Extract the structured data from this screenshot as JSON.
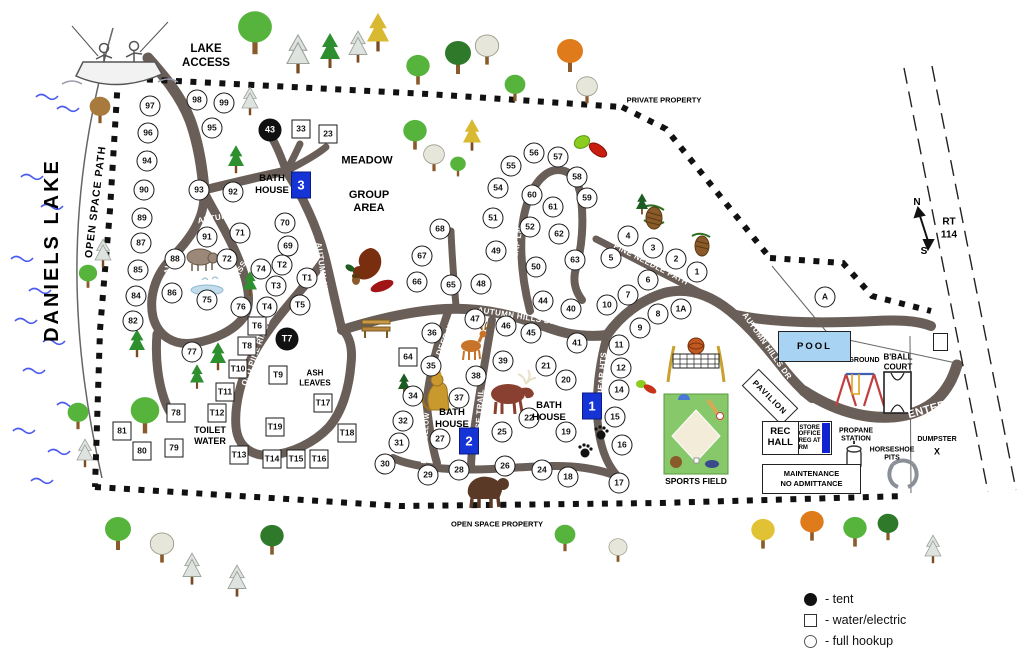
{
  "labels": {
    "daniels_lake": "DANIELS LAKE",
    "open_space_path": "OPEN SPACE PATH",
    "lake_access_1": "LAKE",
    "lake_access_2": "ACCESS",
    "private_property": "PRIVATE PROPERTY",
    "open_space_property": "OPEN SPACE PROPERTY",
    "meadow": "MEADOW",
    "group_1": "GROUP",
    "group_2": "AREA",
    "ash_1": "ASH",
    "ash_2": "LEAVES",
    "toilet_1": "TOILET",
    "toilet_2": "WATER",
    "pool": "POOL",
    "pavilion": "PAVILION",
    "playground": "PLAYGROUND",
    "bball_1": "B'BALL",
    "bball_2": "COURT",
    "sports_field": "SPORTS FIELD",
    "rec_1": "REC",
    "rec_2": "HALL",
    "store_1": "STORE",
    "store_2": "OFFICE",
    "store_3": "REG AT RM",
    "propane_1": "PROPANE",
    "propane_2": "STATION",
    "horseshoe_1": "HORSESHOE",
    "horseshoe_2": "PITS",
    "dumpster": "DUMPSTER",
    "dumpster_x": "X",
    "maintenance_1": "MAINTENANCE",
    "maintenance_2": "NO ADMITTANCE",
    "rt_1": "RT",
    "rt_2": "114",
    "compass_n": "N",
    "compass_s": "S"
  },
  "bath_houses": [
    {
      "number": "3",
      "label": "BATH HOUSE",
      "text_x": 272,
      "text_y": 185,
      "box_x": 301,
      "box_y": 185
    },
    {
      "number": "1",
      "label": "BATH HOUSE",
      "text_x": 549,
      "text_y": 412,
      "box_x": 592,
      "box_y": 406
    },
    {
      "number": "2",
      "label": "BATH HOUSE",
      "text_x": 452,
      "text_y": 419,
      "box_x": 469,
      "box_y": 441
    }
  ],
  "road_labels": [
    {
      "text": "LAKESIDE LANDING",
      "x": 172,
      "y": 237,
      "r": -82,
      "fs": 8
    },
    {
      "text": "AUTUMN HILLS DR",
      "x": 237,
      "y": 214,
      "r": -10,
      "fs": 8
    },
    {
      "text": "BASS PASS",
      "x": 233,
      "y": 283,
      "r": -62,
      "fs": 8
    },
    {
      "text": "AUTUMN HILLS DR",
      "x": 324,
      "y": 282,
      "r": 82,
      "fs": 8
    },
    {
      "text": "OLD PINE RIDGE",
      "x": 256,
      "y": 352,
      "r": -70,
      "fs": 8
    },
    {
      "text": "ACORN WAY",
      "x": 439,
      "y": 266,
      "r": -84,
      "fs": 8
    },
    {
      "text": "DEER HILL",
      "x": 447,
      "y": 334,
      "r": -68,
      "fs": 8
    },
    {
      "text": "FOX HOLLOW",
      "x": 426,
      "y": 438,
      "r": -86,
      "fs": 7
    },
    {
      "text": "MOOSE TRAIL",
      "x": 479,
      "y": 419,
      "r": -86,
      "fs": 8
    },
    {
      "text": "BEAR HTS",
      "x": 602,
      "y": 374,
      "r": -85,
      "fs": 8
    },
    {
      "text": "LEAF LN",
      "x": 517,
      "y": 245,
      "r": -80,
      "fs": 8
    },
    {
      "text": "PINE NEEDLE PATH",
      "x": 651,
      "y": 264,
      "r": 27,
      "fs": 8
    },
    {
      "text": "AUTUMN HILLS DR",
      "x": 517,
      "y": 316,
      "r": 9,
      "fs": 8
    },
    {
      "text": "AUTUMN HILLS DR",
      "x": 767,
      "y": 346,
      "r": 55,
      "fs": 8
    },
    {
      "text": "ENTER",
      "x": 927,
      "y": 410,
      "r": -16,
      "fs": 11
    }
  ],
  "sites": {
    "full_hookup": [
      {
        "id": "97",
        "x": 150,
        "y": 106
      },
      {
        "id": "98",
        "x": 197,
        "y": 100
      },
      {
        "id": "99",
        "x": 224,
        "y": 103
      },
      {
        "id": "96",
        "x": 148,
        "y": 133
      },
      {
        "id": "95",
        "x": 212,
        "y": 128
      },
      {
        "id": "94",
        "x": 147,
        "y": 161
      },
      {
        "id": "93",
        "x": 199,
        "y": 190
      },
      {
        "id": "92",
        "x": 233,
        "y": 192
      },
      {
        "id": "91",
        "x": 207,
        "y": 237
      },
      {
        "id": "90",
        "x": 144,
        "y": 190
      },
      {
        "id": "89",
        "x": 142,
        "y": 218
      },
      {
        "id": "88",
        "x": 175,
        "y": 259
      },
      {
        "id": "87",
        "x": 141,
        "y": 243
      },
      {
        "id": "86",
        "x": 172,
        "y": 293
      },
      {
        "id": "85",
        "x": 138,
        "y": 270
      },
      {
        "id": "84",
        "x": 136,
        "y": 296
      },
      {
        "id": "82",
        "x": 133,
        "y": 321
      },
      {
        "id": "77",
        "x": 192,
        "y": 352
      },
      {
        "id": "76",
        "x": 241,
        "y": 307
      },
      {
        "id": "75",
        "x": 207,
        "y": 300
      },
      {
        "id": "74",
        "x": 261,
        "y": 269
      },
      {
        "id": "72",
        "x": 227,
        "y": 259
      },
      {
        "id": "71",
        "x": 240,
        "y": 233
      },
      {
        "id": "70",
        "x": 285,
        "y": 223
      },
      {
        "id": "69",
        "x": 288,
        "y": 246
      },
      {
        "id": "68",
        "x": 440,
        "y": 229
      },
      {
        "id": "67",
        "x": 422,
        "y": 256
      },
      {
        "id": "66",
        "x": 417,
        "y": 282
      },
      {
        "id": "65",
        "x": 451,
        "y": 285
      },
      {
        "id": "63",
        "x": 575,
        "y": 260
      },
      {
        "id": "62",
        "x": 559,
        "y": 234
      },
      {
        "id": "61",
        "x": 553,
        "y": 207
      },
      {
        "id": "60",
        "x": 532,
        "y": 195
      },
      {
        "id": "59",
        "x": 587,
        "y": 198
      },
      {
        "id": "58",
        "x": 577,
        "y": 177
      },
      {
        "id": "57",
        "x": 558,
        "y": 157
      },
      {
        "id": "56",
        "x": 534,
        "y": 153
      },
      {
        "id": "55",
        "x": 511,
        "y": 166
      },
      {
        "id": "54",
        "x": 498,
        "y": 188
      },
      {
        "id": "52",
        "x": 530,
        "y": 227
      },
      {
        "id": "51",
        "x": 493,
        "y": 218
      },
      {
        "id": "50",
        "x": 536,
        "y": 267
      },
      {
        "id": "49",
        "x": 496,
        "y": 251
      },
      {
        "id": "48",
        "x": 481,
        "y": 284
      },
      {
        "id": "47",
        "x": 475,
        "y": 319
      },
      {
        "id": "46",
        "x": 506,
        "y": 326
      },
      {
        "id": "45",
        "x": 531,
        "y": 333
      },
      {
        "id": "44",
        "x": 543,
        "y": 301
      },
      {
        "id": "41",
        "x": 577,
        "y": 343
      },
      {
        "id": "40",
        "x": 571,
        "y": 309
      },
      {
        "id": "39",
        "x": 503,
        "y": 361
      },
      {
        "id": "38",
        "x": 476,
        "y": 376
      },
      {
        "id": "37",
        "x": 459,
        "y": 398
      },
      {
        "id": "36",
        "x": 432,
        "y": 333
      },
      {
        "id": "35",
        "x": 431,
        "y": 366
      },
      {
        "id": "34",
        "x": 413,
        "y": 396
      },
      {
        "id": "32",
        "x": 403,
        "y": 421
      },
      {
        "id": "31",
        "x": 399,
        "y": 443
      },
      {
        "id": "30",
        "x": 385,
        "y": 464
      },
      {
        "id": "29",
        "x": 428,
        "y": 475
      },
      {
        "id": "28",
        "x": 459,
        "y": 470
      },
      {
        "id": "27",
        "x": 440,
        "y": 439
      },
      {
        "id": "26",
        "x": 505,
        "y": 466
      },
      {
        "id": "25",
        "x": 502,
        "y": 432
      },
      {
        "id": "24",
        "x": 542,
        "y": 470
      },
      {
        "id": "22",
        "x": 529,
        "y": 418
      },
      {
        "id": "21",
        "x": 546,
        "y": 366
      },
      {
        "id": "20",
        "x": 566,
        "y": 380
      },
      {
        "id": "19",
        "x": 566,
        "y": 432
      },
      {
        "id": "18",
        "x": 568,
        "y": 477
      },
      {
        "id": "17",
        "x": 619,
        "y": 483
      },
      {
        "id": "16",
        "x": 622,
        "y": 445
      },
      {
        "id": "15",
        "x": 615,
        "y": 417
      },
      {
        "id": "14",
        "x": 619,
        "y": 390
      },
      {
        "id": "12",
        "x": 621,
        "y": 368
      },
      {
        "id": "11",
        "x": 619,
        "y": 345
      },
      {
        "id": "10",
        "x": 607,
        "y": 305
      },
      {
        "id": "9",
        "x": 640,
        "y": 328
      },
      {
        "id": "8",
        "x": 658,
        "y": 314
      },
      {
        "id": "7",
        "x": 628,
        "y": 295
      },
      {
        "id": "6",
        "x": 648,
        "y": 280
      },
      {
        "id": "5",
        "x": 611,
        "y": 258
      },
      {
        "id": "4",
        "x": 628,
        "y": 236
      },
      {
        "id": "3",
        "x": 653,
        "y": 248
      },
      {
        "id": "2",
        "x": 676,
        "y": 259
      },
      {
        "id": "1",
        "x": 697,
        "y": 272
      },
      {
        "id": "1A",
        "x": 681,
        "y": 309
      },
      {
        "id": "T1",
        "x": 307,
        "y": 278
      },
      {
        "id": "T2",
        "x": 282,
        "y": 265
      },
      {
        "id": "T3",
        "x": 276,
        "y": 286
      },
      {
        "id": "T4",
        "x": 267,
        "y": 307
      },
      {
        "id": "T5",
        "x": 300,
        "y": 305
      }
    ],
    "water_electric": [
      {
        "id": "33",
        "x": 301,
        "y": 129
      },
      {
        "id": "23",
        "x": 328,
        "y": 134
      },
      {
        "id": "64",
        "x": 408,
        "y": 357
      },
      {
        "id": "78",
        "x": 176,
        "y": 413
      },
      {
        "id": "79",
        "x": 174,
        "y": 448
      },
      {
        "id": "80",
        "x": 142,
        "y": 451
      },
      {
        "id": "81",
        "x": 122,
        "y": 431
      },
      {
        "id": "T6",
        "x": 257,
        "y": 326
      },
      {
        "id": "T8",
        "x": 247,
        "y": 346
      },
      {
        "id": "T9",
        "x": 278,
        "y": 375
      },
      {
        "id": "T10",
        "x": 238,
        "y": 369
      },
      {
        "id": "T11",
        "x": 225,
        "y": 392
      },
      {
        "id": "T12",
        "x": 217,
        "y": 413
      },
      {
        "id": "T13",
        "x": 239,
        "y": 455
      },
      {
        "id": "T14",
        "x": 272,
        "y": 459
      },
      {
        "id": "T15",
        "x": 296,
        "y": 459
      },
      {
        "id": "T16",
        "x": 319,
        "y": 459
      },
      {
        "id": "T17",
        "x": 323,
        "y": 403
      },
      {
        "id": "T18",
        "x": 347,
        "y": 433
      },
      {
        "id": "T19",
        "x": 275,
        "y": 427
      }
    ],
    "tent": [
      {
        "id": "43",
        "x": 270,
        "y": 130
      },
      {
        "id": "T7",
        "x": 287,
        "y": 339
      }
    ]
  },
  "area_marker": {
    "id": "A",
    "x": 825,
    "y": 297
  },
  "legend": {
    "items": [
      {
        "symbol": "tent",
        "label": "- tent"
      },
      {
        "symbol": "water_electric",
        "label": "- water/electric"
      },
      {
        "symbol": "full_hookup",
        "label": "- full hookup"
      }
    ]
  },
  "colors": {
    "road": "#6a5f58",
    "bath_house_blue": "#1634d6",
    "pool_fill": "#a9d3f2",
    "boundary": "#111111",
    "wave_blue": "#4b5bf0"
  },
  "illustrations": [
    "fisherman-boat",
    "wild-boar",
    "pond",
    "moose",
    "deer",
    "mountain-lion",
    "black-bear",
    "bear-paw-prints",
    "park-bench",
    "oak-leaves-acorn",
    "maple-leaves",
    "pine-cones",
    "volleyball-net",
    "baseball-field",
    "swing-set",
    "basketball-court",
    "horseshoe",
    "propane-tank"
  ],
  "trees": [
    {
      "t": "oak",
      "x": 255,
      "y": 62,
      "s": 1.3
    },
    {
      "t": "white_pine",
      "x": 298,
      "y": 80,
      "s": 1.1
    },
    {
      "t": "pine",
      "x": 330,
      "y": 74,
      "s": 1.0
    },
    {
      "t": "white_pine",
      "x": 358,
      "y": 68,
      "s": 0.9
    },
    {
      "t": "yellow_pine",
      "x": 378,
      "y": 58,
      "s": 1.1
    },
    {
      "t": "oak",
      "x": 418,
      "y": 90,
      "s": 0.9
    },
    {
      "t": "dark_oak",
      "x": 458,
      "y": 80,
      "s": 1.0
    },
    {
      "t": "sparse",
      "x": 487,
      "y": 70,
      "s": 0.9
    },
    {
      "t": "oak",
      "x": 515,
      "y": 106,
      "s": 0.8
    },
    {
      "t": "orange",
      "x": 570,
      "y": 78,
      "s": 1.0
    },
    {
      "t": "sparse",
      "x": 587,
      "y": 108,
      "s": 0.8
    },
    {
      "t": "brown",
      "x": 100,
      "y": 128,
      "s": 0.8
    },
    {
      "t": "white_pine",
      "x": 250,
      "y": 120,
      "s": 0.8
    },
    {
      "t": "pine",
      "x": 236,
      "y": 178,
      "s": 0.8
    },
    {
      "t": "white_pine",
      "x": 103,
      "y": 272,
      "s": 0.8
    },
    {
      "t": "oak",
      "x": 88,
      "y": 292,
      "s": 0.7
    },
    {
      "t": "pine",
      "x": 137,
      "y": 362,
      "s": 0.8
    },
    {
      "t": "pine",
      "x": 218,
      "y": 375,
      "s": 0.8
    },
    {
      "t": "pine",
      "x": 197,
      "y": 393,
      "s": 0.7
    },
    {
      "t": "pine",
      "x": 250,
      "y": 300,
      "s": 0.7
    },
    {
      "t": "oak",
      "x": 78,
      "y": 434,
      "s": 0.8
    },
    {
      "t": "white_pine",
      "x": 85,
      "y": 472,
      "s": 0.8
    },
    {
      "t": "oak",
      "x": 145,
      "y": 440,
      "s": 1.1
    },
    {
      "t": "pine_dark",
      "x": 404,
      "y": 398,
      "s": 0.6
    },
    {
      "t": "oak",
      "x": 415,
      "y": 155,
      "s": 0.9
    },
    {
      "t": "sparse",
      "x": 434,
      "y": 176,
      "s": 0.8
    },
    {
      "t": "oak",
      "x": 458,
      "y": 180,
      "s": 0.6
    },
    {
      "t": "yellow_pine",
      "x": 472,
      "y": 156,
      "s": 0.9
    },
    {
      "t": "pine_dark",
      "x": 642,
      "y": 218,
      "s": 0.6
    },
    {
      "t": "oak",
      "x": 118,
      "y": 556,
      "s": 1.0
    },
    {
      "t": "sparse",
      "x": 162,
      "y": 568,
      "s": 0.9
    },
    {
      "t": "white_pine",
      "x": 192,
      "y": 590,
      "s": 0.9
    },
    {
      "t": "white_pine",
      "x": 237,
      "y": 602,
      "s": 0.9
    },
    {
      "t": "dark_oak",
      "x": 272,
      "y": 560,
      "s": 0.9
    },
    {
      "t": "oak",
      "x": 565,
      "y": 556,
      "s": 0.8
    },
    {
      "t": "sparse",
      "x": 618,
      "y": 566,
      "s": 0.7
    },
    {
      "t": "yellow",
      "x": 763,
      "y": 554,
      "s": 0.9
    },
    {
      "t": "orange",
      "x": 812,
      "y": 546,
      "s": 0.9
    },
    {
      "t": "oak",
      "x": 855,
      "y": 552,
      "s": 0.9
    },
    {
      "t": "dark_oak",
      "x": 888,
      "y": 545,
      "s": 0.8
    },
    {
      "t": "white_pine",
      "x": 933,
      "y": 568,
      "s": 0.8
    }
  ],
  "waves": [
    {
      "x": 20,
      "y": 168
    },
    {
      "x": 40,
      "y": 198
    },
    {
      "x": 10,
      "y": 250
    },
    {
      "x": 28,
      "y": 282
    },
    {
      "x": 14,
      "y": 312
    },
    {
      "x": 42,
      "y": 333
    },
    {
      "x": 22,
      "y": 362
    },
    {
      "x": 56,
      "y": 396
    },
    {
      "x": 12,
      "y": 422
    },
    {
      "x": 47,
      "y": 443
    },
    {
      "x": 30,
      "y": 472
    },
    {
      "x": 35,
      "y": 88
    },
    {
      "x": 56,
      "y": 100
    }
  ]
}
